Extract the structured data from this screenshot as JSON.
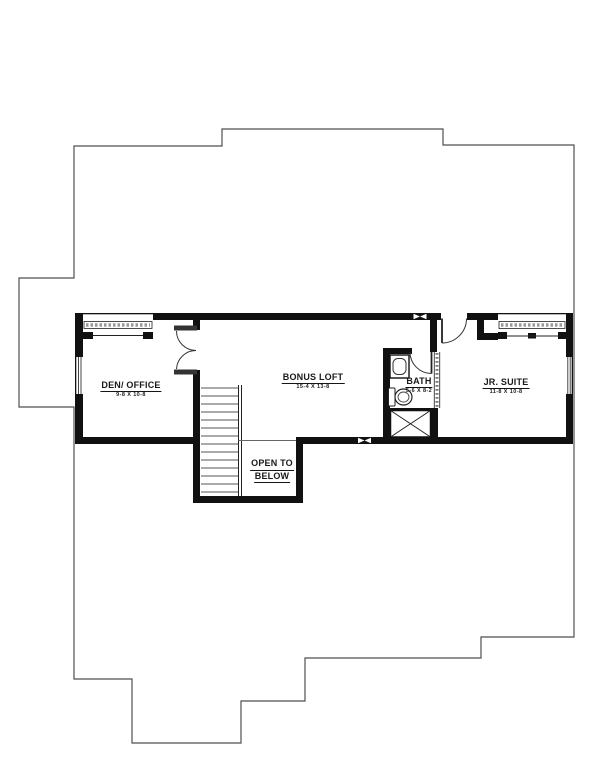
{
  "drawing": {
    "type": "second-floor-plan",
    "background": "#ffffff"
  },
  "rooms": {
    "den_office": {
      "label": "DEN/ OFFICE",
      "dims": "9-8 X 10-8"
    },
    "bonus_loft": {
      "label": "BONUS LOFT",
      "dims": "15-4 X 13-8"
    },
    "bath": {
      "label": "BATH",
      "dims": "5-6 X 8-2"
    },
    "jr_suite": {
      "label": "JR. SUITE",
      "dims": "11-8 X 10-8"
    },
    "open_to_below": {
      "line1": "OPEN TO",
      "line2": "BELOW"
    }
  },
  "colors": {
    "wall": "#111111",
    "outline": "#4f4f4f",
    "text": "#1a1a1a",
    "background": "#ffffff"
  },
  "symbols": {
    "stairs": "stair-treads",
    "window": "double-line-window",
    "door": "quarter-arc-swing-door",
    "double_door": "butterfly-double-door",
    "wall_marker": "bowtie-marker",
    "shower": "x-crossed-box",
    "toilet": "toilet-fixture",
    "vanity": "vanity-sink"
  }
}
